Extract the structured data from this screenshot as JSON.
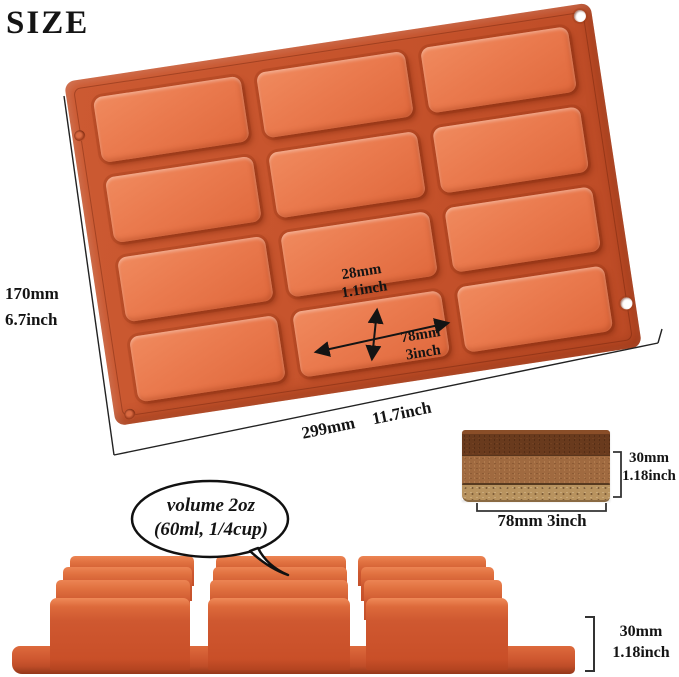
{
  "title": "SIZE",
  "colors": {
    "mold": "#cd5830",
    "mold_cavity": "#ea7a4e",
    "annotation_ink": "#141414",
    "brownie_top": "#693a1d",
    "brownie_middle": "#a06a40",
    "brownie_base": "#b8935f"
  },
  "mold": {
    "cavity_rows": 4,
    "cavity_cols": 3,
    "cavity_count": 12
  },
  "dims": {
    "overall_width": {
      "mm": "170mm",
      "inch": "6.7inch"
    },
    "overall_length": {
      "mm": "299mm",
      "inch": "11.7inch"
    },
    "cavity_width": {
      "mm": "28mm",
      "inch": "1.1inch"
    },
    "cavity_length": {
      "mm": "78mm",
      "inch": "3inch"
    },
    "cavity_depth": {
      "mm": "30mm",
      "inch": "1.18inch"
    },
    "bar_height": {
      "mm": "30mm",
      "inch": "1.18inch"
    },
    "bar_length": {
      "mm": "78mm",
      "inch": "3inch"
    }
  },
  "bubble": {
    "line1": "volume 2oz",
    "line2": "(60ml, 1/4cup)"
  }
}
